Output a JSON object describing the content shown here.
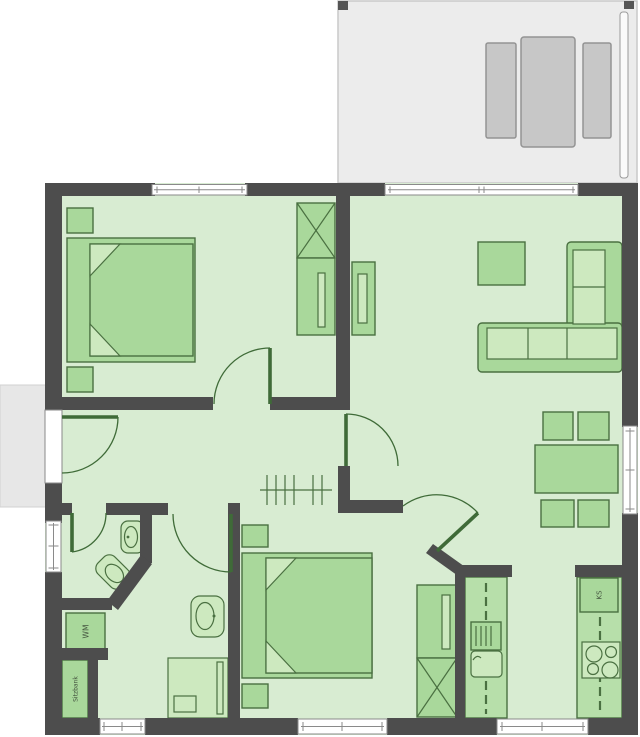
{
  "plan": {
    "labels": {
      "washing_machine": "WM",
      "bench": "Sitzbank",
      "fridge": "KS"
    },
    "icons": [
      "double-bed-icon",
      "nightstand-icon",
      "wardrobe-x-icon",
      "tv-board-icon",
      "coffee-table-icon",
      "corner-sofa-icon",
      "dining-table-icon",
      "chair-icon",
      "coat-rack-icon",
      "washbasin-icon",
      "toilet-icon",
      "shower-icon",
      "kitchen-sink-icon",
      "stove-icon",
      "terrace-lounge-icon",
      "window-icon",
      "door-swing-icon"
    ]
  },
  "colors": {
    "wall": "#4d4d4d",
    "floor": "#d8ecd2",
    "furniture": "#a9d89b",
    "furniture_stroke": "#4a7041",
    "furniture_light": "#cde9bf",
    "counter": "#b7dfaa",
    "terrace": "#ececec",
    "terrace_furniture": "#c7c7c7",
    "window": "#ffffff",
    "door": "#3f6b38",
    "label_text": "#44543f"
  }
}
